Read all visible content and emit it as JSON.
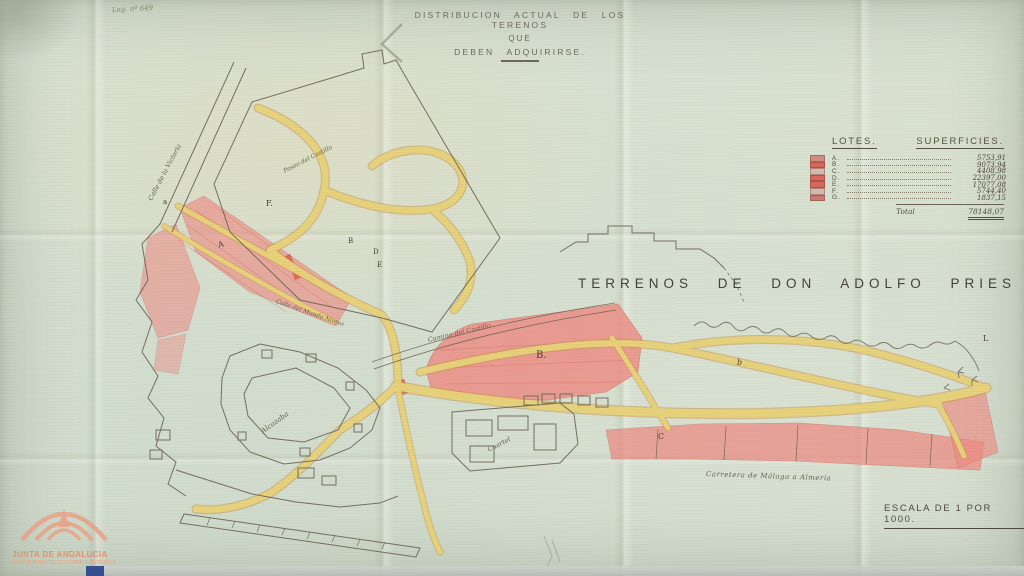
{
  "header": {
    "archive_ref": "Leg. nº 649"
  },
  "title": {
    "line1": "DISTRIBUCION ACTUAL DE LOS TERENOS",
    "line2": "QUE",
    "line3": "DEBEN ADQUIRIRSE."
  },
  "main_label": "TERRENOS DE DON ADOLFO PRIES",
  "scale": "ESCALA DE 1 POR 1000.",
  "legend": {
    "header_lotes": "LOTES.",
    "header_superficies": "SUPERFICIES.",
    "rows": [
      {
        "lot": "A.",
        "area": "5753,91",
        "swatch_style": "background:#cf8d84"
      },
      {
        "lot": "B.",
        "area": "9073,94",
        "swatch_style": "background:#d9675c"
      },
      {
        "lot": "C.",
        "area": "4408,98",
        "swatch_style": "background:#d8b9ae"
      },
      {
        "lot": "D.",
        "area": "22397,00",
        "swatch_style": "background:#d9675c"
      },
      {
        "lot": "E.",
        "area": "17077,08",
        "swatch_style": "background:#d9675c"
      },
      {
        "lot": "F.",
        "area": "5744,40",
        "swatch_style": "background:#d8b9ae"
      },
      {
        "lot": "G.",
        "area": "1837,15",
        "swatch_style": "background:#c97c6f"
      }
    ],
    "total_label": "Total",
    "total_value": "78148,07"
  },
  "map_labels": [
    {
      "text": "Calle de la Victoria"
    },
    {
      "text": "Paseo del Castillo"
    },
    {
      "text": "Calle del Mundo Nuevo"
    },
    {
      "text": "Camino del Castillo"
    },
    {
      "text": "Alcazaba"
    },
    {
      "text": "Cuartel"
    },
    {
      "text": "Carretera de Málaga a Almería"
    }
  ],
  "lot_markers": [
    {
      "t": "a"
    },
    {
      "t": "F."
    },
    {
      "t": "A"
    },
    {
      "t": "B"
    },
    {
      "t": "D"
    },
    {
      "t": "E"
    },
    {
      "t": "B."
    },
    {
      "t": "b"
    },
    {
      "t": "C"
    },
    {
      "t": "L"
    }
  ],
  "watermark": {
    "line1": "JUNTA DE ANDALUCIA",
    "line2": "CONSEJERÍA DE CULTURA Y DEPORTE"
  },
  "colors": {
    "road_yellow": "#e9d47c",
    "road_casing": "#c89248",
    "lot_pink": "#ee8b83",
    "lot_red": "#dd5048",
    "ink": "#6b6254",
    "logo_salmon": "#eb9e83"
  }
}
